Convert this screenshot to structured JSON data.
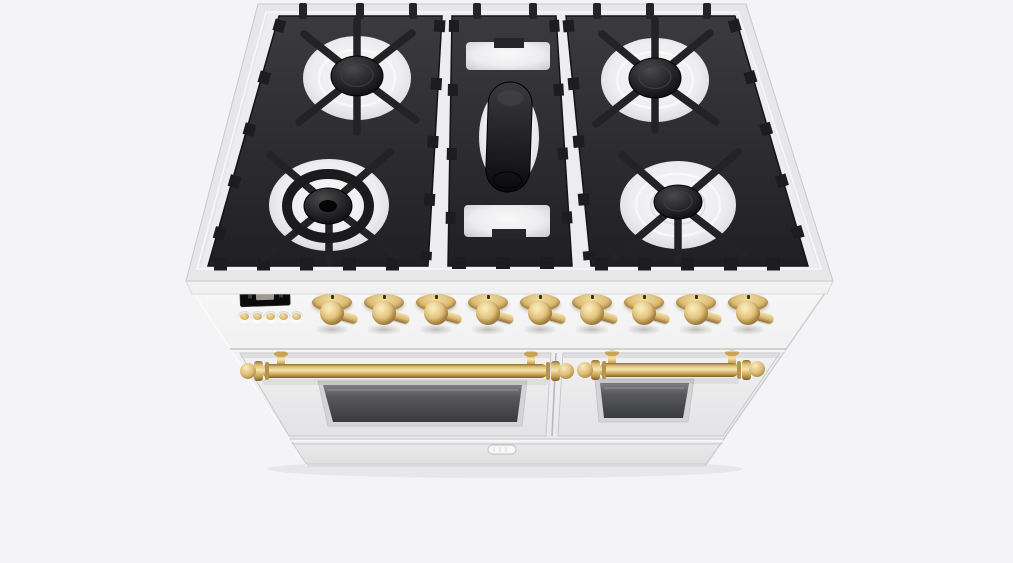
{
  "scene": {
    "description": "3D product render of a white freestanding dual-oven range cooker with brass hardware and black cast-iron gas grates, viewed from the upper front",
    "background_color": "#f4f4f7"
  },
  "palette": {
    "body_white": "#efeff1",
    "brass": "#ddbb75",
    "grate_black": "#29292b",
    "drip_tray_steel": "#ededef",
    "oven_glass": "#4a4a4d"
  },
  "cooktop": {
    "grate_sections": 3,
    "burners": [
      {
        "name": "rear-left-burner",
        "type": "round sealed burner, black cap"
      },
      {
        "name": "front-left-dual-ring-burner",
        "type": "large dual-ring wok burner, black cap"
      },
      {
        "name": "center-oval-griddle-burner",
        "type": "elongated oval griddle burner"
      },
      {
        "name": "rear-right-burner",
        "type": "round sealed burner, black cap"
      },
      {
        "name": "front-right-burner",
        "type": "round sealed burner, black cap"
      }
    ]
  },
  "control_panel": {
    "display": {
      "name": "oven-clock-display",
      "state": "unlit",
      "value": ""
    },
    "clock_buttons": [
      {
        "name": "clock-button-1"
      },
      {
        "name": "clock-button-2"
      },
      {
        "name": "clock-button-3"
      },
      {
        "name": "clock-button-4"
      },
      {
        "name": "clock-button-5"
      }
    ],
    "knobs": [
      {
        "name": "control-knob-1"
      },
      {
        "name": "control-knob-2"
      },
      {
        "name": "control-knob-3"
      },
      {
        "name": "control-knob-4"
      },
      {
        "name": "control-knob-5"
      },
      {
        "name": "control-knob-6"
      },
      {
        "name": "control-knob-7"
      },
      {
        "name": "control-knob-8"
      },
      {
        "name": "control-knob-9"
      }
    ]
  },
  "ovens": {
    "left_door": {
      "name": "left-oven-door",
      "handle": "brass rail handle with ball finials",
      "window": "tinted glass window"
    },
    "right_door": {
      "name": "right-oven-door",
      "handle": "brass rail handle with ball finials",
      "window": "tinted glass window"
    }
  },
  "base": {
    "latch": {
      "name": "lower-drawer-latch"
    }
  }
}
